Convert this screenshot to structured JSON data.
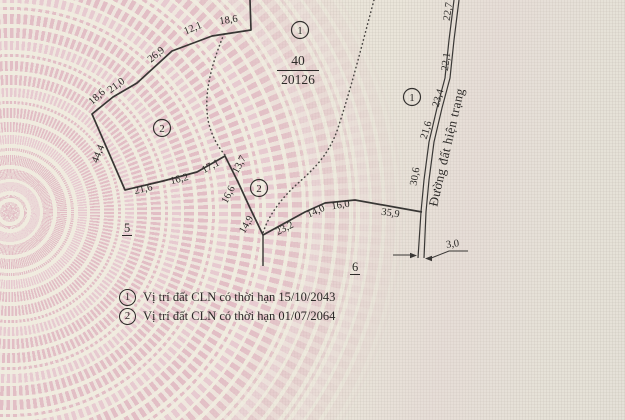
{
  "colors": {
    "ink": "#2c2a28",
    "line": "#3a3836",
    "pattern_pink": "#e2bec5",
    "paper": "#f0ebde"
  },
  "parcel": {
    "number": "40",
    "area": "20126"
  },
  "zones": {
    "left": "5",
    "right": "6"
  },
  "markers": {
    "zone1": "1",
    "zone2": "2"
  },
  "road": {
    "label": "Đường đất hiện trạng",
    "width_label": "3,0"
  },
  "dims": {
    "a18_6": "18,6",
    "a12_1": "12,1",
    "a26_9": "26,9",
    "a21_0": "21,0",
    "b18_6": "18,6",
    "a44_4": "44,4",
    "a21_6": "21,6",
    "a16_2": "16,2",
    "a17_1": "17,1",
    "a13_7": "13,7",
    "a16_6": "16,6",
    "a14_9": "14,9",
    "a23_2": "23,2",
    "a14_0": "14,0",
    "a16_0": "16,0",
    "a35_9": "35,9",
    "r22_7": "22,7",
    "r22_1": "22,1",
    "r23_4": "23,4",
    "r21_6": "21,6",
    "r30_6": "30,6"
  },
  "legend": {
    "items": [
      {
        "num": "1",
        "text": "Vị trí đất CLN có thời hạn 15/10/2043"
      },
      {
        "num": "2",
        "text": "Vị trí đất CLN có thời hạn 01/07/2064"
      }
    ]
  }
}
